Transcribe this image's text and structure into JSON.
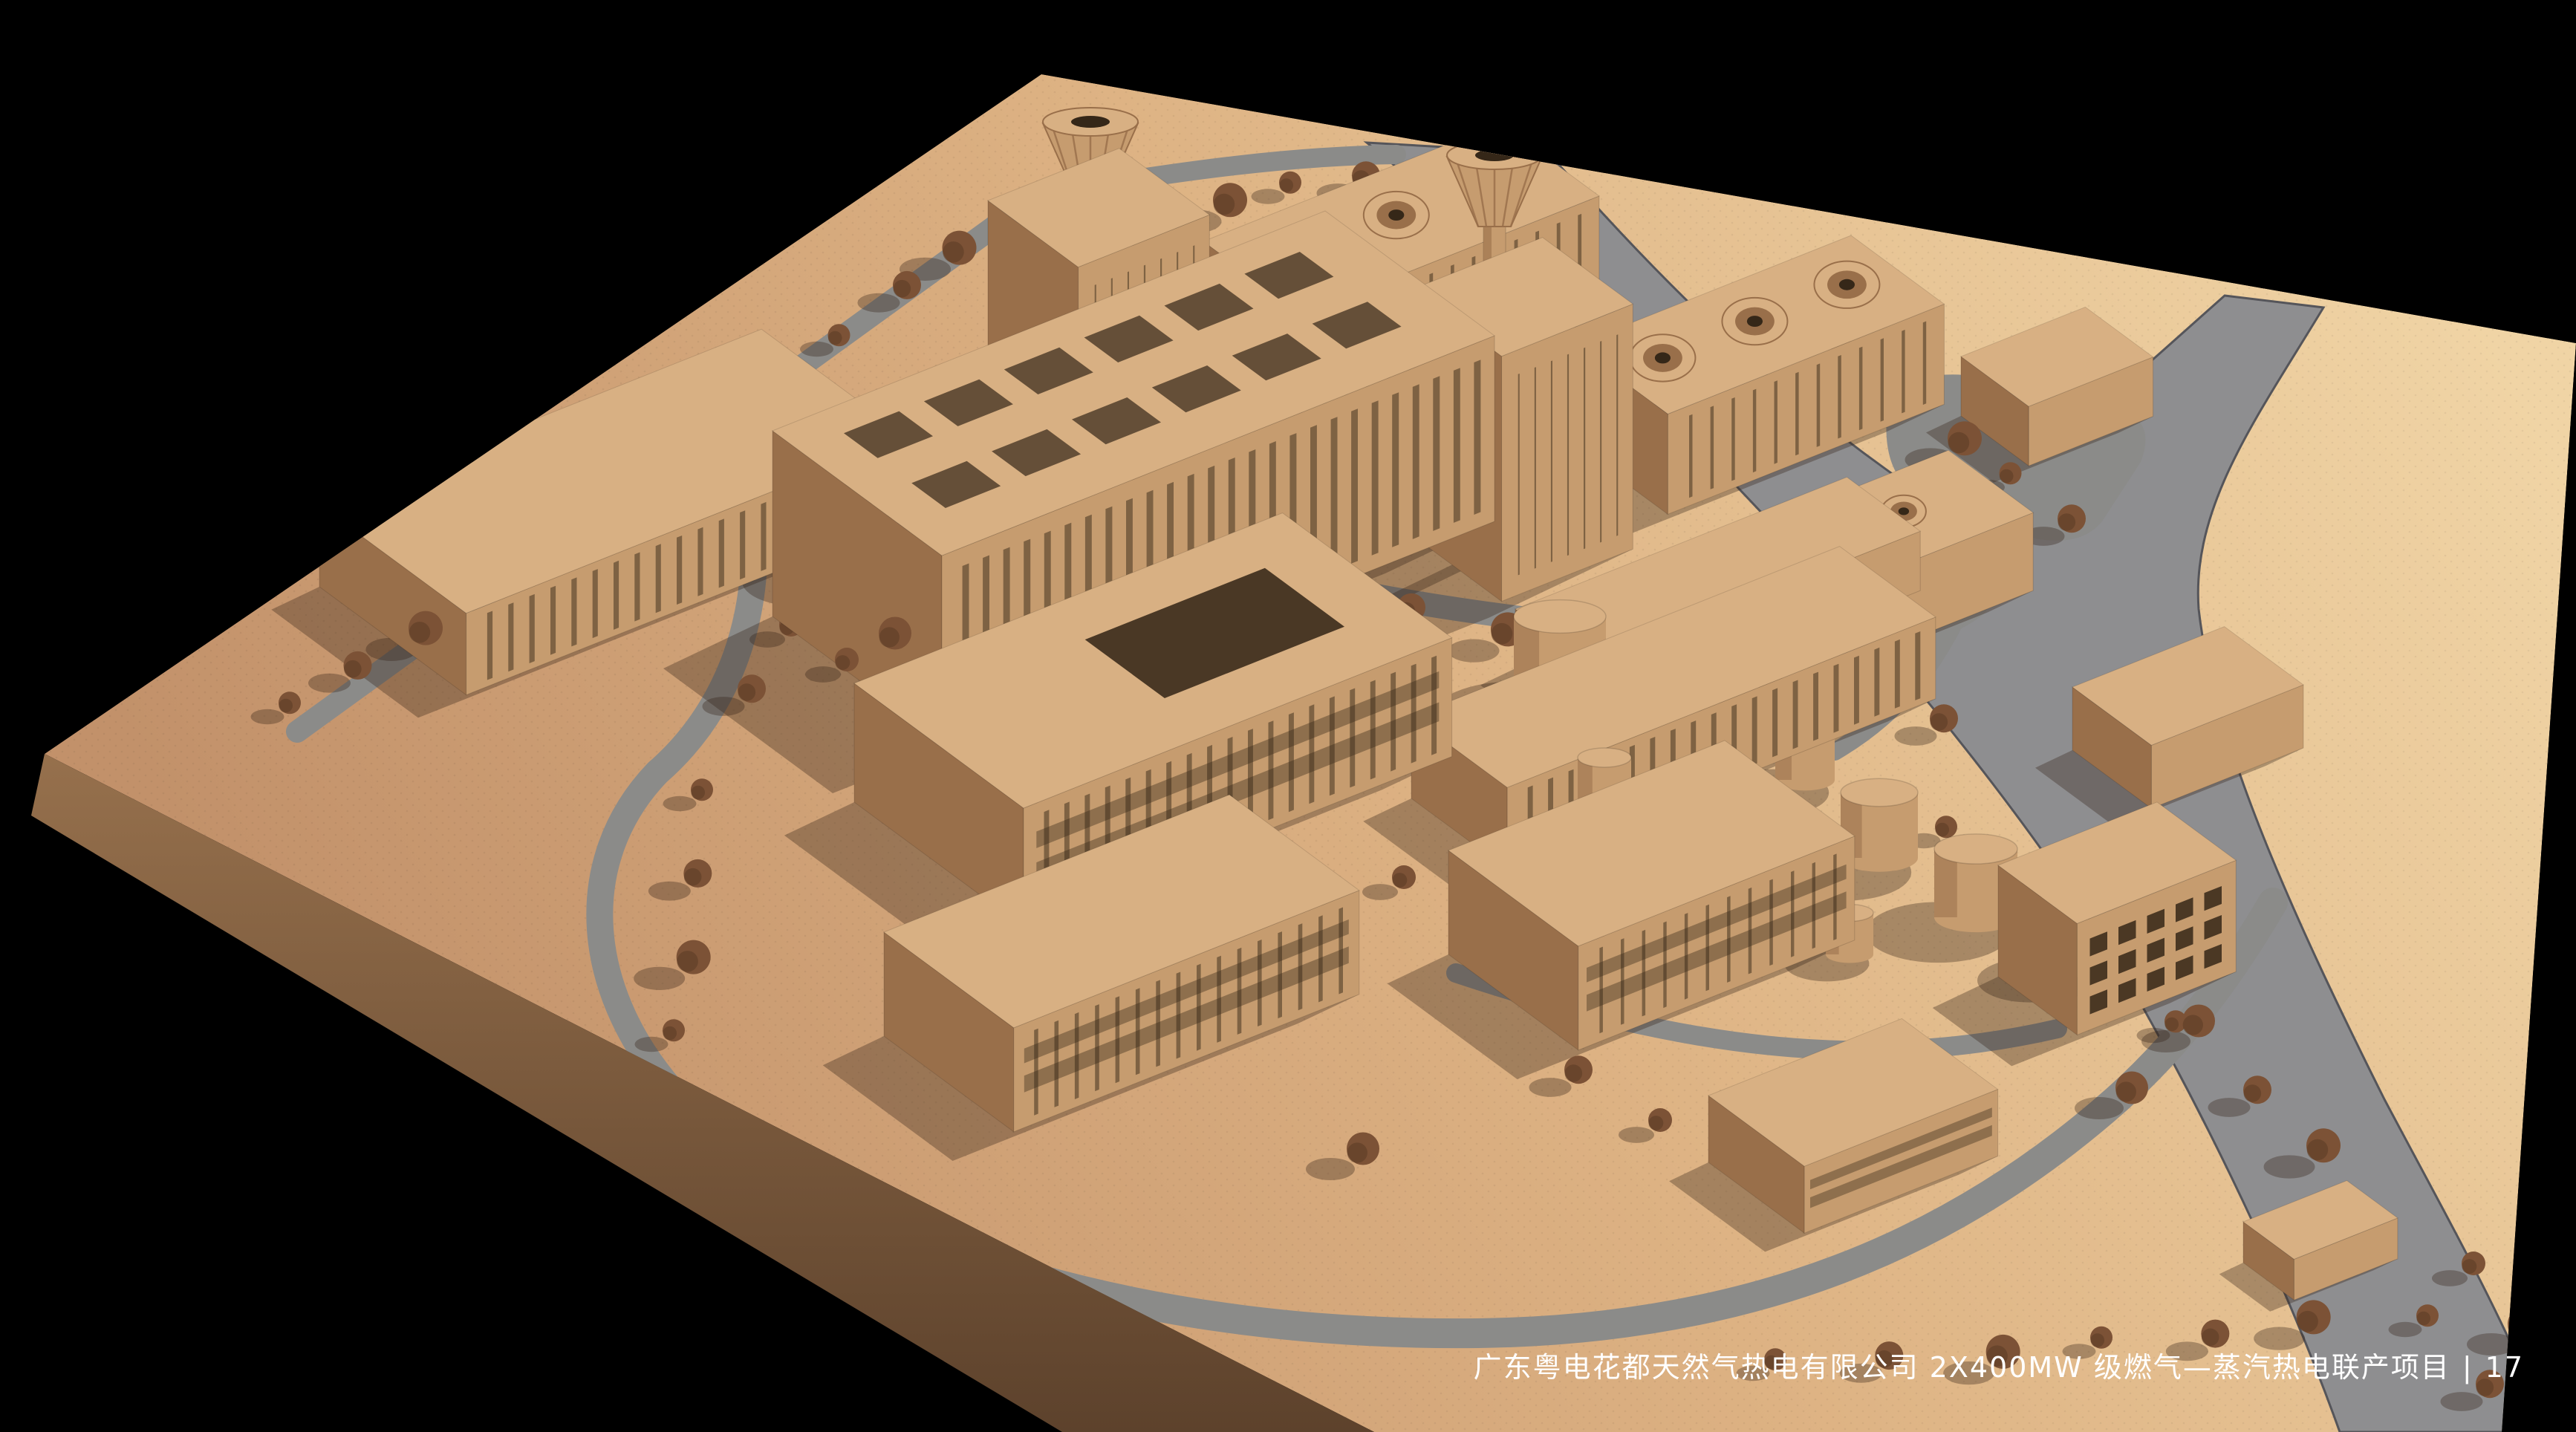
{
  "caption": {
    "project_title": "广东粤电花都天然气热电有限公司 2X400MW 级燃气—蒸汽热电联产项目",
    "divider": "|",
    "page_number": "17"
  },
  "palette": {
    "background": "#000000",
    "ground_light": "#f0d4a5",
    "ground_mid": "#ddb283",
    "ground_dark": "#c2916a",
    "platform_side": "#97714d",
    "platform_side_dark": "#5d422c",
    "river": "#8e8e90",
    "road": "#8b8b89",
    "pond": "#7d7d83",
    "roof": "#d8b083",
    "wall_light": "#c69c6f",
    "wall_dark": "#996f4a",
    "window": "#352718",
    "tree": "#7c5236",
    "tree_dark": "#5e3e26",
    "shadow": "rgba(52,36,24,0.34)",
    "river_edge": "#55555a",
    "text": "#ffffff"
  }
}
